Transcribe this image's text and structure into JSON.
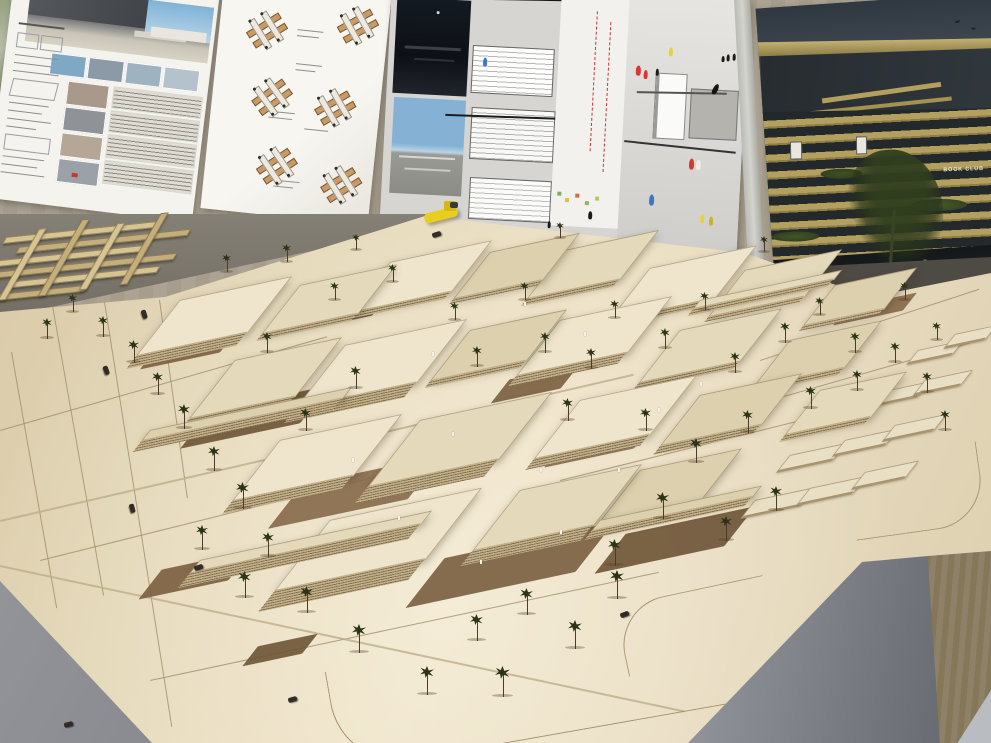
{
  "scene": {
    "description": "Photograph of a wooden architectural site model on a large plywood table, with student presentation boards pinned to cork panels behind it",
    "model_material": "laser-cut plywood with layered slab buildings, palm trees, tiny figures and cars",
    "legible_text": [
      "BOOK CLUB"
    ]
  },
  "boards": {
    "left": {
      "content": "renderings, photo thumbnails, facade elevation strips, technical notes"
    },
    "middle": {
      "content": "white sheet with small cross-shaped module axonometric diagrams"
    },
    "center": {
      "content": "large collage: night and day renderings, stepped building linework, site plan with module outlines, plaza scene with colored figures"
    },
    "right": {
      "sign": "BOOK CLUB",
      "content": "photo of slatted timber-band building with planting, dark sky, street trees"
    }
  },
  "palette": {
    "cork_wall": "#a89f8e",
    "plywood": "#e3d6b6",
    "roof_tones": [
      "#eee5cc",
      "#e4d9ba",
      "#dcd0ae"
    ],
    "slab_stripe_light": "#c2b08a",
    "slab_stripe_dark": "#7e6b4c",
    "courtyard_brown": "#7a5e3f",
    "palm_green": "#2c3317",
    "road_line": "#a5906c",
    "floor_gray": "#8f9196",
    "pedestal_gray": "#84878d",
    "gold_slat": "#b3a05e",
    "dark_slat": "#23282a",
    "accent_yellow": "#e8cf1f",
    "figure_red": "#d63838",
    "figure_blue": "#3a78c9",
    "figure_yellow": "#e8d23a"
  },
  "model": {
    "buildings": [
      {
        "x": 180,
        "y": 300,
        "w": 110,
        "h": 55,
        "b": 14,
        "t": 0
      },
      {
        "x": 300,
        "y": 285,
        "w": 95,
        "h": 48,
        "b": 8,
        "t": 1
      },
      {
        "x": 390,
        "y": 262,
        "w": 100,
        "h": 50,
        "b": 8,
        "t": 0
      },
      {
        "x": 490,
        "y": 252,
        "w": 88,
        "h": 46,
        "b": 6,
        "t": 2
      },
      {
        "x": 565,
        "y": 250,
        "w": 92,
        "h": 48,
        "b": 8,
        "t": 1
      },
      {
        "x": 650,
        "y": 268,
        "w": 105,
        "h": 52,
        "b": 8,
        "t": 0
      },
      {
        "x": 745,
        "y": 270,
        "w": 95,
        "h": 46,
        "b": 6,
        "t": 1
      },
      {
        "x": 835,
        "y": 285,
        "w": 80,
        "h": 40,
        "b": 6,
        "t": 2
      },
      {
        "x": 235,
        "y": 360,
        "w": 105,
        "h": 58,
        "b": 10,
        "t": 1
      },
      {
        "x": 345,
        "y": 345,
        "w": 120,
        "h": 62,
        "b": 16,
        "t": 0
      },
      {
        "x": 470,
        "y": 330,
        "w": 95,
        "h": 50,
        "b": 8,
        "t": 2
      },
      {
        "x": 560,
        "y": 320,
        "w": 110,
        "h": 55,
        "b": 12,
        "t": 0
      },
      {
        "x": 680,
        "y": 330,
        "w": 100,
        "h": 52,
        "b": 8,
        "t": 1
      },
      {
        "x": 790,
        "y": 340,
        "w": 90,
        "h": 46,
        "b": 8,
        "t": 2
      },
      {
        "x": 280,
        "y": 440,
        "w": 120,
        "h": 60,
        "b": 14,
        "t": 0
      },
      {
        "x": 420,
        "y": 420,
        "w": 130,
        "h": 66,
        "b": 18,
        "t": 1
      },
      {
        "x": 580,
        "y": 400,
        "w": 115,
        "h": 58,
        "b": 12,
        "t": 0
      },
      {
        "x": 700,
        "y": 395,
        "w": 100,
        "h": 50,
        "b": 10,
        "t": 2
      },
      {
        "x": 820,
        "y": 390,
        "w": 85,
        "h": 44,
        "b": 8,
        "t": 1
      },
      {
        "x": 330,
        "y": 520,
        "w": 150,
        "h": 70,
        "b": 22,
        "t": 0
      },
      {
        "x": 520,
        "y": 490,
        "w": 120,
        "h": 60,
        "b": 16,
        "t": 1
      },
      {
        "x": 640,
        "y": 470,
        "w": 100,
        "h": 50,
        "b": 10,
        "t": 2
      },
      {
        "x": 150,
        "y": 430,
        "w": 200,
        "h": 10,
        "b": 12,
        "t": 2
      },
      {
        "x": 200,
        "y": 560,
        "w": 230,
        "h": 12,
        "b": 16,
        "t": 1
      },
      {
        "x": 600,
        "y": 520,
        "w": 160,
        "h": 10,
        "b": 10,
        "t": 2
      },
      {
        "x": 700,
        "y": 300,
        "w": 140,
        "h": 8,
        "b": 8,
        "t": 1
      }
    ],
    "blocks": [
      {
        "x": 755,
        "y": 500,
        "w": 58,
        "h": 16
      },
      {
        "x": 810,
        "y": 488,
        "w": 55,
        "h": 15
      },
      {
        "x": 865,
        "y": 472,
        "w": 52,
        "h": 15
      },
      {
        "x": 790,
        "y": 455,
        "w": 55,
        "h": 15
      },
      {
        "x": 845,
        "y": 440,
        "w": 52,
        "h": 14
      },
      {
        "x": 895,
        "y": 425,
        "w": 50,
        "h": 14
      },
      {
        "x": 830,
        "y": 405,
        "w": 50,
        "h": 14
      },
      {
        "x": 880,
        "y": 392,
        "w": 48,
        "h": 13
      },
      {
        "x": 925,
        "y": 380,
        "w": 46,
        "h": 13
      },
      {
        "x": 918,
        "y": 350,
        "w": 44,
        "h": 12
      },
      {
        "x": 955,
        "y": 334,
        "w": 40,
        "h": 12
      }
    ],
    "palms": [
      [
        42,
        338,
        10
      ],
      [
        68,
        312,
        9
      ],
      [
        98,
        336,
        10
      ],
      [
        128,
        362,
        11
      ],
      [
        152,
        394,
        11
      ],
      [
        178,
        428,
        12
      ],
      [
        208,
        470,
        12
      ],
      [
        236,
        508,
        13
      ],
      [
        196,
        549,
        12
      ],
      [
        262,
        556,
        12
      ],
      [
        238,
        597,
        13
      ],
      [
        300,
        612,
        13
      ],
      [
        352,
        652,
        14
      ],
      [
        420,
        694,
        14
      ],
      [
        495,
        696,
        15
      ],
      [
        568,
        648,
        14
      ],
      [
        610,
        598,
        14
      ],
      [
        470,
        640,
        13
      ],
      [
        520,
        614,
        13
      ],
      [
        262,
        352,
        10
      ],
      [
        330,
        300,
        9
      ],
      [
        388,
        282,
        9
      ],
      [
        350,
        388,
        11
      ],
      [
        300,
        430,
        11
      ],
      [
        450,
        320,
        9
      ],
      [
        520,
        300,
        9
      ],
      [
        472,
        366,
        10
      ],
      [
        540,
        352,
        10
      ],
      [
        610,
        318,
        9
      ],
      [
        586,
        368,
        10
      ],
      [
        660,
        348,
        10
      ],
      [
        700,
        310,
        9
      ],
      [
        730,
        372,
        10
      ],
      [
        780,
        342,
        10
      ],
      [
        815,
        315,
        9
      ],
      [
        850,
        352,
        10
      ],
      [
        562,
        420,
        11
      ],
      [
        640,
        430,
        11
      ],
      [
        690,
        462,
        12
      ],
      [
        742,
        432,
        11
      ],
      [
        805,
        408,
        11
      ],
      [
        852,
        390,
        10
      ],
      [
        890,
        362,
        10
      ],
      [
        922,
        392,
        10
      ],
      [
        940,
        430,
        10
      ],
      [
        608,
        565,
        13
      ],
      [
        656,
        518,
        13
      ],
      [
        720,
        540,
        12
      ],
      [
        770,
        510,
        12
      ],
      [
        222,
        272,
        9
      ],
      [
        282,
        262,
        9
      ],
      [
        352,
        250,
        8
      ],
      [
        556,
        238,
        8
      ],
      [
        760,
        252,
        8
      ],
      [
        900,
        300,
        9
      ],
      [
        932,
        340,
        9
      ]
    ],
    "people": [
      [
        398,
        516
      ],
      [
        452,
        432
      ],
      [
        540,
        468
      ],
      [
        432,
        352
      ],
      [
        658,
        408
      ],
      [
        700,
        382
      ],
      [
        524,
        302
      ],
      [
        584,
        332
      ],
      [
        352,
        458
      ],
      [
        618,
        468
      ],
      [
        480,
        560
      ],
      [
        560,
        530
      ]
    ],
    "cars": [
      [
        102,
        368,
        70
      ],
      [
        128,
        506,
        75
      ],
      [
        194,
        565,
        -18
      ],
      [
        288,
        697,
        -15
      ],
      [
        620,
        612,
        -20
      ],
      [
        432,
        232,
        -18
      ],
      [
        64,
        722,
        -14
      ],
      [
        140,
        312,
        72
      ]
    ],
    "patches": [
      [
        150,
        335,
        80,
        26
      ],
      [
        195,
        398,
        120,
        38
      ],
      [
        285,
        470,
        140,
        44
      ],
      [
        425,
        540,
        170,
        50
      ],
      [
        610,
        520,
        130,
        40
      ],
      [
        555,
        430,
        90,
        28
      ],
      [
        500,
        372,
        70,
        24
      ],
      [
        320,
        302,
        60,
        20
      ],
      [
        840,
        300,
        70,
        18
      ],
      [
        150,
        560,
        90,
        30
      ],
      [
        250,
        640,
        60,
        20
      ]
    ],
    "roads": [
      [
        52,
        300,
        300,
        80
      ],
      [
        105,
        302,
        430,
        81
      ],
      [
        12,
        352,
        260,
        80
      ],
      [
        160,
        300,
        200,
        82
      ],
      [
        0,
        430,
        340,
        -16
      ],
      [
        40,
        560,
        420,
        -14
      ],
      [
        150,
        680,
        520,
        -12
      ],
      [
        560,
        480,
        400,
        -14
      ],
      [
        700,
        420,
        280,
        -16
      ],
      [
        760,
        360,
        230,
        -18
      ]
    ],
    "seams": [
      [
        0,
        565,
        700,
        12
      ],
      [
        0,
        520,
        650,
        -13
      ]
    ],
    "sticks": [
      [
        10,
        10,
        150,
        5
      ],
      [
        30,
        22,
        170,
        5
      ],
      [
        0,
        34,
        160,
        5
      ],
      [
        20,
        46,
        180,
        5
      ],
      [
        40,
        58,
        150,
        5
      ],
      [
        5,
        70,
        120,
        5
      ],
      [
        40,
        5,
        6,
        70
      ],
      [
        80,
        0,
        6,
        75
      ],
      [
        120,
        8,
        6,
        65
      ],
      [
        160,
        2,
        6,
        70
      ]
    ],
    "modules": [
      {
        "x": 28,
        "y": 30,
        "r": -38
      },
      {
        "x": 118,
        "y": 16,
        "r": -35
      },
      {
        "x": 40,
        "y": 96,
        "r": -42
      },
      {
        "x": 104,
        "y": 100,
        "r": -36
      },
      {
        "x": 52,
        "y": 164,
        "r": -40
      },
      {
        "x": 118,
        "y": 176,
        "r": -38
      }
    ],
    "figures": [
      {
        "x": 248,
        "y": 72,
        "c": "#d63838",
        "h": 10
      },
      {
        "x": 256,
        "y": 76,
        "c": "#d63838",
        "h": 9
      },
      {
        "x": 268,
        "y": 74,
        "c": "#1a1a1a",
        "h": 7
      },
      {
        "x": 326,
        "y": 86,
        "c": "#141414",
        "h": 11,
        "r": 24
      },
      {
        "x": 338,
        "y": 56,
        "c": "#1a1a1a",
        "h": 7
      },
      {
        "x": 344,
        "y": 55,
        "c": "#1a1a1a",
        "h": 7
      },
      {
        "x": 350,
        "y": 57,
        "c": "#1a1a1a",
        "h": 7
      },
      {
        "x": 333,
        "y": 58,
        "c": "#1a1a1a",
        "h": 6
      },
      {
        "x": 280,
        "y": 52,
        "c": "#e8d23a",
        "h": 9
      },
      {
        "x": 95,
        "y": 72,
        "c": "#3a78c9",
        "h": 9
      },
      {
        "x": 268,
        "y": 200,
        "c": "#3a78c9",
        "h": 11
      },
      {
        "x": 306,
        "y": 162,
        "c": "#d63838",
        "h": 11
      },
      {
        "x": 313,
        "y": 163,
        "c": "#eceae2",
        "h": 10
      },
      {
        "x": 320,
        "y": 217,
        "c": "#e8d23a",
        "h": 9
      },
      {
        "x": 329,
        "y": 219,
        "c": "#c9b12e",
        "h": 9
      },
      {
        "x": 208,
        "y": 220,
        "c": "#1a1a1a",
        "h": 8
      },
      {
        "x": 168,
        "y": 232,
        "c": "#1a1a1a",
        "h": 7
      }
    ]
  }
}
